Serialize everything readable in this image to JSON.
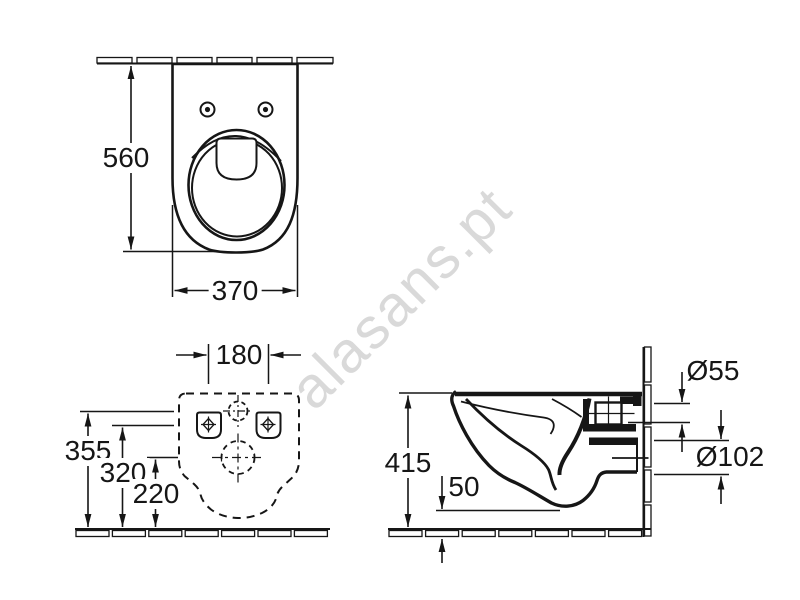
{
  "watermark": {
    "text": "alasans.pt"
  },
  "dimensions": {
    "top_view": {
      "depth": "560",
      "width": "370"
    },
    "rear_view": {
      "fixing_hole_spacing": "180",
      "inlet_center_height": "355",
      "fixing_hole_height": "320",
      "outlet_center_height": "220"
    },
    "side_view": {
      "rim_height": "415",
      "bottom_clearance": "50",
      "inlet_diameter": "Ø55",
      "outlet_diameter": "Ø102"
    }
  },
  "colors": {
    "line": "#161616",
    "watermark": "#d9d9d9",
    "background": "#ffffff"
  }
}
